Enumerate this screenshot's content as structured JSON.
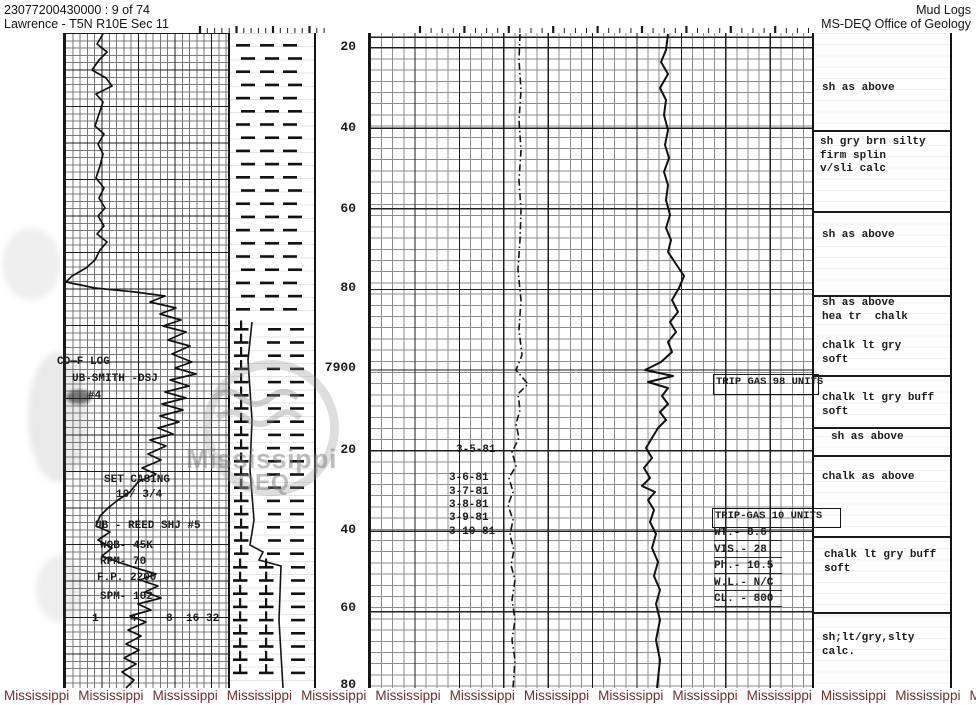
{
  "header": {
    "doc_id": "23077200430000 : 9 of 74",
    "location": "Lawrence - T5N R10E Sec 11",
    "title": "Mud Logs",
    "org": "MS-DEQ Office of Geology"
  },
  "footer": {
    "word": "Mississippi",
    "count": 15,
    "color": "#6e2f2f"
  },
  "stamp": {
    "line1": "Mississippi",
    "line2": "DEQ"
  },
  "depth_labels": [
    {
      "t": "20",
      "y": 40
    },
    {
      "t": "40",
      "y": 121
    },
    {
      "t": "60",
      "y": 202
    },
    {
      "t": "80",
      "y": 281
    },
    {
      "t": "7900",
      "y": 361
    },
    {
      "t": "20",
      "y": 443
    },
    {
      "t": "40",
      "y": 523
    },
    {
      "t": "60",
      "y": 601
    },
    {
      "t": "80",
      "y": 678
    }
  ],
  "scale_ticks": {
    "y": 613,
    "items": [
      {
        "t": "1",
        "x": 92
      },
      {
        "t": "4",
        "x": 130
      },
      {
        "t": "8",
        "x": 166
      },
      {
        "t": "16",
        "x": 186
      },
      {
        "t": "32",
        "x": 206
      }
    ]
  },
  "left_annotations": [
    {
      "text": "CO—F LOG",
      "x": 57,
      "y": 356
    },
    {
      "text": "UB-SMITH -DSJ",
      "x": 72,
      "y": 373
    },
    {
      "text": "#4",
      "x": 88,
      "y": 390
    },
    {
      "text": "SET CASING",
      "x": 104,
      "y": 474
    },
    {
      "text": "10/ 3/4",
      "x": 116,
      "y": 489
    },
    {
      "text": "UB - REED SHJ #5",
      "x": 95,
      "y": 520
    },
    {
      "text": "WOB- 45K",
      "x": 100,
      "y": 540
    },
    {
      "text": "RPM- 70",
      "x": 100,
      "y": 556
    },
    {
      "text": "F.P. 2200",
      "x": 97,
      "y": 572
    },
    {
      "text": "SPM- 102",
      "x": 100,
      "y": 591
    }
  ],
  "dates": [
    {
      "text": "3-5-81",
      "x": 456,
      "y": 444
    },
    {
      "text": "3-6-81",
      "x": 449,
      "y": 472
    },
    {
      "text": "3-7-81",
      "x": 449,
      "y": 486
    },
    {
      "text": "3-8-81",
      "x": 449,
      "y": 499
    },
    {
      "text": "3-9-81",
      "x": 449,
      "y": 512
    },
    {
      "text": "3-10-81",
      "x": 449,
      "y": 526
    }
  ],
  "trip_boxes": [
    {
      "label": "TRIP GAS 98 UNITS",
      "x": 713,
      "y": 374,
      "w": 100,
      "h": 17
    },
    {
      "label": "TRIP-GAS 10 UNITS",
      "x": 712,
      "y": 508,
      "w": 123,
      "h": 16
    }
  ],
  "mud_data": {
    "x": 714,
    "y": 527,
    "lines": [
      "WT.- 8.6",
      "VIS.- 28",
      "Ph.- 10.5",
      "W.L.- N/C",
      "CL. - 800"
    ]
  },
  "right_blocks": [
    {
      "x": 822,
      "y": 82,
      "lines": [
        "sh as above"
      ]
    },
    {
      "x": 820,
      "y": 136,
      "lines": [
        "sh gry brn silty",
        "firm splin",
        "v/sli calc"
      ]
    },
    {
      "x": 822,
      "y": 229,
      "lines": [
        "sh as above"
      ]
    },
    {
      "x": 822,
      "y": 297,
      "lines": [
        "sh as above",
        "hea tr  chalk"
      ]
    },
    {
      "x": 822,
      "y": 340,
      "lines": [
        "chalk lt gry",
        "soft"
      ]
    },
    {
      "x": 822,
      "y": 392,
      "lines": [
        "chalk lt gry buff",
        "soft"
      ]
    },
    {
      "x": 831,
      "y": 431,
      "lines": [
        "sh as above"
      ]
    },
    {
      "x": 822,
      "y": 471,
      "lines": [
        "chalk as above"
      ]
    },
    {
      "x": 824,
      "y": 549,
      "lines": [
        "chalk lt gry buff",
        "soft"
      ]
    },
    {
      "x": 822,
      "y": 632,
      "lines": [
        "sh;lt/gry,slty",
        "calc."
      ]
    }
  ],
  "separators": [
    130,
    211,
    295,
    375,
    427,
    455,
    536,
    612
  ],
  "ruler": [
    {
      "x1": 200,
      "x2": 330,
      "step": 7.3,
      "major": 5
    },
    {
      "x1": 420,
      "x2": 810,
      "step": 11.1,
      "major": 4
    }
  ],
  "curves": {
    "track1": {
      "color": "#101010",
      "width": 1.7,
      "points": [
        [
          103,
          34
        ],
        [
          97,
          44
        ],
        [
          107,
          52
        ],
        [
          99,
          60
        ],
        [
          92,
          70
        ],
        [
          106,
          78
        ],
        [
          112,
          86
        ],
        [
          96,
          94
        ],
        [
          103,
          102
        ],
        [
          99,
          114
        ],
        [
          95,
          126
        ],
        [
          104,
          134
        ],
        [
          98,
          144
        ],
        [
          103,
          154
        ],
        [
          100,
          166
        ],
        [
          96,
          178
        ],
        [
          104,
          188
        ],
        [
          99,
          198
        ],
        [
          105,
          208
        ],
        [
          98,
          216
        ],
        [
          104,
          226
        ],
        [
          97,
          234
        ],
        [
          107,
          242
        ],
        [
          100,
          250
        ],
        [
          95,
          260
        ],
        [
          86,
          268
        ],
        [
          72,
          276
        ],
        [
          66,
          282
        ],
        [
          95,
          288
        ],
        [
          135,
          292
        ],
        [
          165,
          296
        ],
        [
          150,
          302
        ],
        [
          176,
          308
        ],
        [
          160,
          314
        ],
        [
          181,
          320
        ],
        [
          163,
          326
        ],
        [
          186,
          332
        ],
        [
          168,
          340
        ],
        [
          190,
          346
        ],
        [
          172,
          354
        ],
        [
          192,
          362
        ],
        [
          175,
          368
        ],
        [
          196,
          374
        ],
        [
          170,
          380
        ],
        [
          189,
          386
        ],
        [
          165,
          392
        ],
        [
          186,
          398
        ],
        [
          162,
          404
        ],
        [
          183,
          410
        ],
        [
          160,
          416
        ],
        [
          179,
          422
        ],
        [
          158,
          428
        ],
        [
          173,
          434
        ],
        [
          150,
          440
        ],
        [
          166,
          446
        ],
        [
          148,
          454
        ],
        [
          161,
          460
        ],
        [
          142,
          468
        ],
        [
          156,
          474
        ],
        [
          138,
          482
        ],
        [
          130,
          492
        ],
        [
          118,
          500
        ],
        [
          108,
          508
        ],
        [
          100,
          516
        ],
        [
          96,
          526
        ],
        [
          110,
          532
        ],
        [
          98,
          540
        ],
        [
          112,
          548
        ],
        [
          102,
          556
        ],
        [
          118,
          562
        ],
        [
          136,
          568
        ],
        [
          156,
          574
        ],
        [
          140,
          580
        ],
        [
          158,
          586
        ],
        [
          145,
          592
        ],
        [
          161,
          598
        ],
        [
          138,
          604
        ],
        [
          151,
          610
        ],
        [
          130,
          616
        ],
        [
          146,
          622
        ],
        [
          128,
          630
        ],
        [
          141,
          636
        ],
        [
          126,
          644
        ],
        [
          139,
          650
        ],
        [
          124,
          658
        ],
        [
          136,
          664
        ],
        [
          122,
          672
        ],
        [
          134,
          680
        ],
        [
          126,
          688
        ]
      ]
    },
    "gas": {
      "color": "#141414",
      "width": 1.6,
      "dash": "7 3 1.5 3",
      "points": [
        [
          520,
          34
        ],
        [
          519,
          60
        ],
        [
          521,
          90
        ],
        [
          519,
          120
        ],
        [
          521,
          150
        ],
        [
          519,
          180
        ],
        [
          521,
          210
        ],
        [
          520,
          240
        ],
        [
          518,
          270
        ],
        [
          521,
          300
        ],
        [
          519,
          330
        ],
        [
          522,
          355
        ],
        [
          516,
          370
        ],
        [
          528,
          384
        ],
        [
          518,
          394
        ],
        [
          520,
          410
        ],
        [
          516,
          424
        ],
        [
          519,
          438
        ],
        [
          512,
          452
        ],
        [
          516,
          466
        ],
        [
          509,
          478
        ],
        [
          513,
          492
        ],
        [
          508,
          505
        ],
        [
          513,
          520
        ],
        [
          510,
          535
        ],
        [
          514,
          550
        ],
        [
          511,
          565
        ],
        [
          515,
          580
        ],
        [
          512,
          600
        ],
        [
          515,
          620
        ],
        [
          512,
          640
        ],
        [
          515,
          660
        ],
        [
          513,
          688
        ]
      ]
    },
    "pressure": {
      "color": "#101010",
      "width": 2,
      "points": [
        [
          668,
          34
        ],
        [
          666,
          50
        ],
        [
          661,
          62
        ],
        [
          668,
          74
        ],
        [
          660,
          88
        ],
        [
          666,
          100
        ],
        [
          664,
          115
        ],
        [
          668,
          130
        ],
        [
          665,
          145
        ],
        [
          669,
          158
        ],
        [
          664,
          172
        ],
        [
          668,
          185
        ],
        [
          666,
          200
        ],
        [
          670,
          215
        ],
        [
          666,
          228
        ],
        [
          671,
          240
        ],
        [
          668,
          252
        ],
        [
          676,
          264
        ],
        [
          684,
          276
        ],
        [
          679,
          288
        ],
        [
          672,
          300
        ],
        [
          678,
          312
        ],
        [
          670,
          322
        ],
        [
          676,
          332
        ],
        [
          668,
          342
        ],
        [
          672,
          352
        ],
        [
          661,
          362
        ],
        [
          645,
          370
        ],
        [
          673,
          376
        ],
        [
          648,
          382
        ],
        [
          668,
          388
        ],
        [
          662,
          396
        ],
        [
          668,
          404
        ],
        [
          660,
          412
        ],
        [
          666,
          420
        ],
        [
          658,
          428
        ],
        [
          652,
          438
        ],
        [
          646,
          448
        ],
        [
          652,
          458
        ],
        [
          644,
          468
        ],
        [
          650,
          478
        ],
        [
          642,
          486
        ],
        [
          655,
          492
        ],
        [
          648,
          500
        ],
        [
          654,
          510
        ],
        [
          650,
          522
        ],
        [
          656,
          534
        ],
        [
          652,
          548
        ],
        [
          658,
          562
        ],
        [
          654,
          576
        ],
        [
          660,
          590
        ],
        [
          656,
          604
        ],
        [
          660,
          620
        ],
        [
          656,
          640
        ],
        [
          660,
          660
        ],
        [
          657,
          688
        ]
      ]
    }
  },
  "lithology": {
    "segments": [
      {
        "from": 38,
        "to": 322,
        "pattern": "shale"
      },
      {
        "from": 322,
        "to": 560,
        "pattern": "chalk1"
      },
      {
        "from": 560,
        "to": 686,
        "pattern": "chalk2"
      }
    ],
    "contact": [
      [
        252,
        322
      ],
      [
        248,
        360
      ],
      [
        252,
        420
      ],
      [
        250,
        470
      ],
      [
        254,
        520
      ],
      [
        250,
        545
      ],
      [
        263,
        552
      ],
      [
        259,
        560
      ],
      [
        281,
        566
      ],
      [
        279,
        620
      ],
      [
        283,
        688
      ]
    ]
  }
}
